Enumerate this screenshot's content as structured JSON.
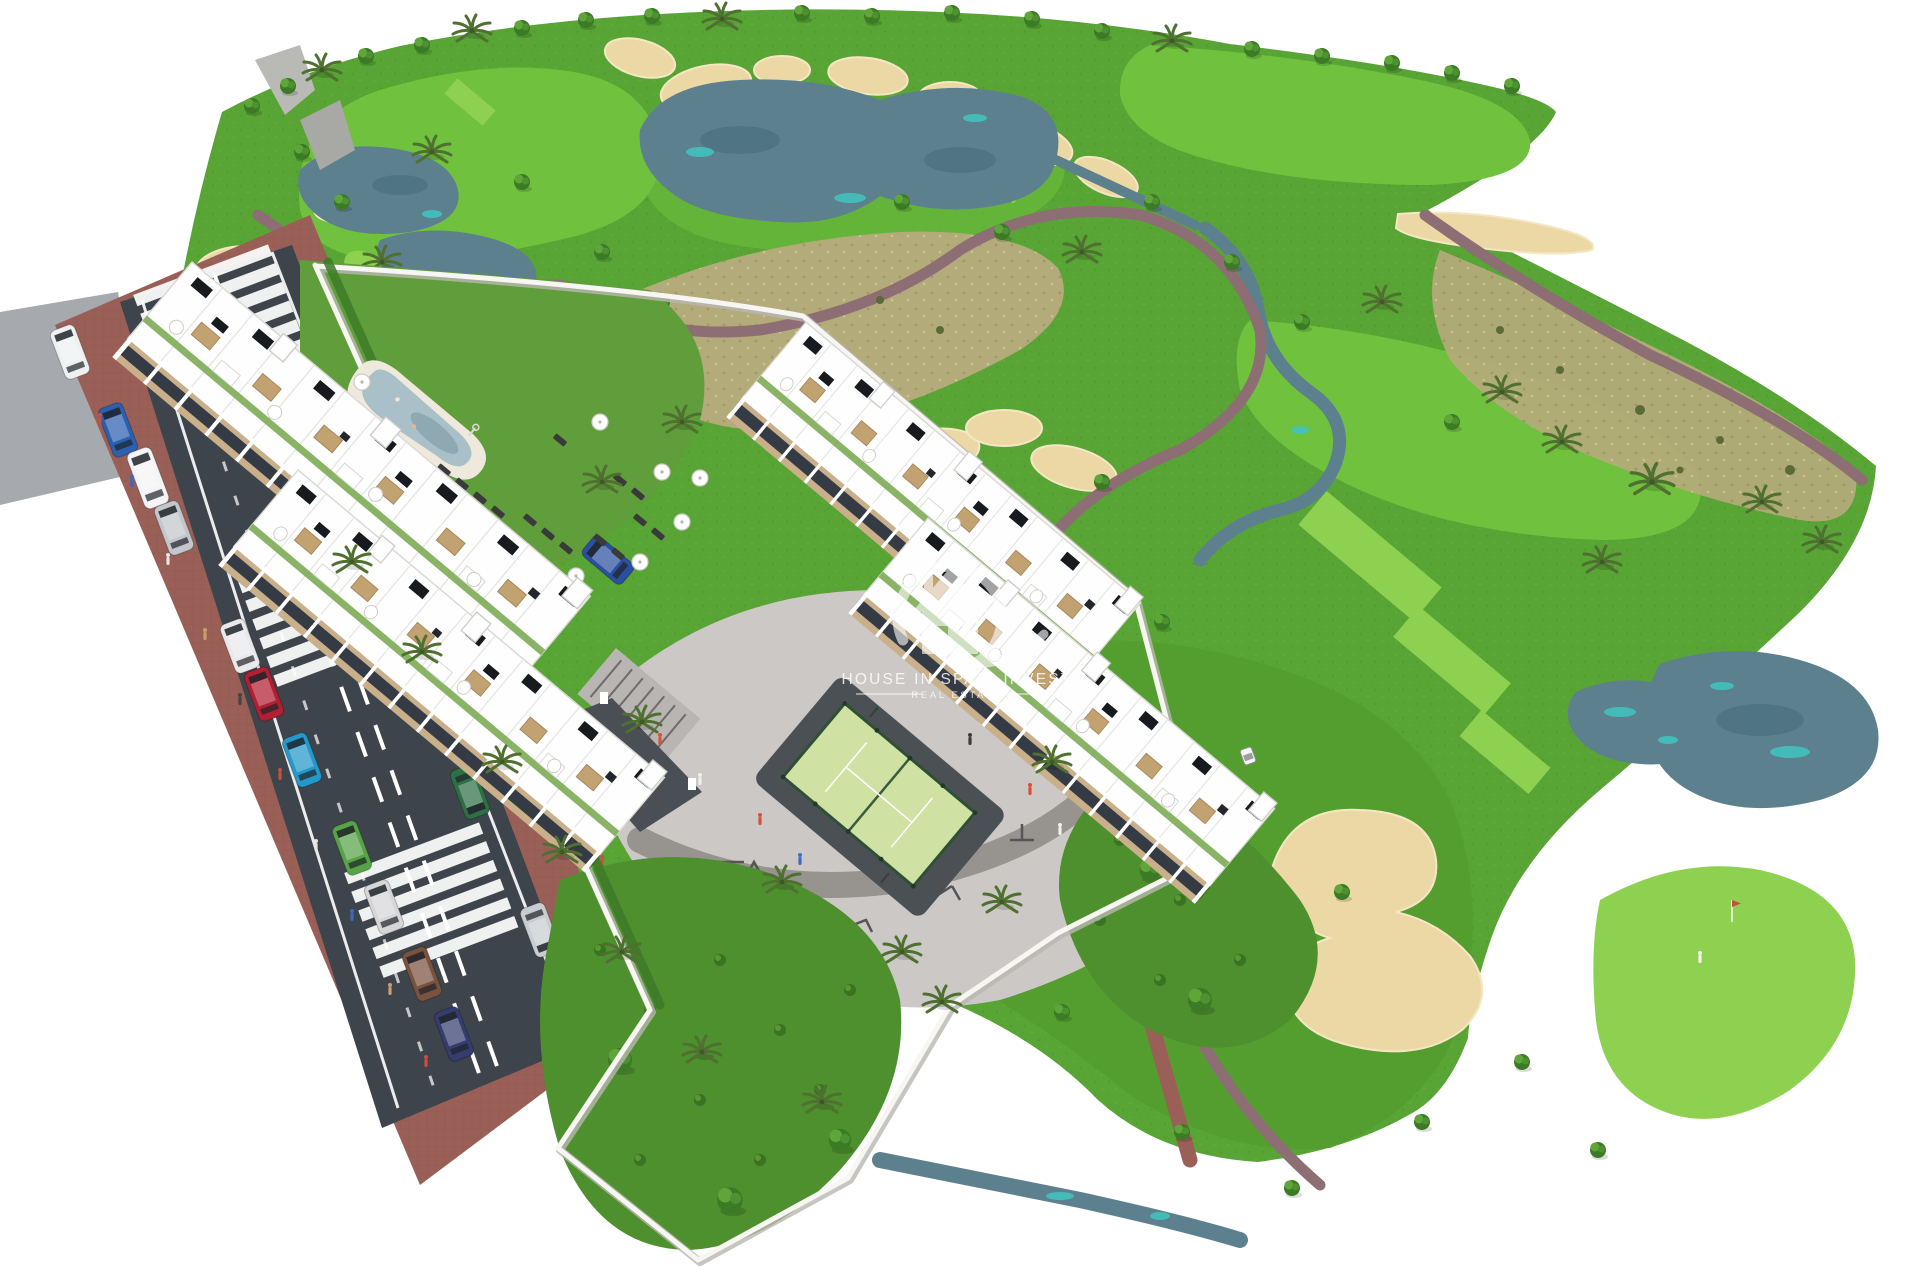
{
  "page": {
    "background": "#ffffff",
    "kind": "aerial-3d-architectural-render",
    "subject": "golf resort apartment development with access road, pool, playground and padel court"
  },
  "watermark": {
    "title": "HOUSE IN SPAIN INVEST",
    "subtitle": "REAL ESTATE",
    "logo": "house-swoosh-icon",
    "color": "#ffffff"
  },
  "palette": {
    "rough_green": "#58a434",
    "fairway_green": "#70c13e",
    "tee_green": "#8ed150",
    "field_green": "#549e30",
    "lawn_green": "#5f9e3b",
    "garden_green": "#4e8f2e",
    "dry_meadow": "#b3ab79",
    "sand_bunker": "#ecd8a4",
    "lake_water": "#5d808f",
    "lake_teal": "#3fc6c0",
    "golf_path": "#8d6e74",
    "sidewalk_brick": "#9a6057",
    "road_asphalt": "#3e444b",
    "plaza_paving": "#cbc8c6",
    "building_white": "#fefefe",
    "facade_wood": "#c9b08b",
    "window_glass": "#353b44",
    "solar_panel": "#171a1f",
    "pool_water": "#a9c0c8",
    "pool_deck": "#efe9dd",
    "padel_court": "#cfe2a4",
    "wall_white": "#f7f6f2"
  },
  "scene": {
    "features": [
      "golf-course",
      "lakes",
      "streams",
      "sand-bunkers",
      "cart-paths",
      "putting-greens",
      "tee-boxes",
      "golf-flag",
      "golfer",
      "golf-cart",
      "palm-trees",
      "deciduous-trees",
      "apartment-block-a1",
      "apartment-block-a2",
      "apartment-block-b1",
      "apartment-block-b2",
      "roof-terraces",
      "solar-panels",
      "pergolas",
      "swimming-pool",
      "pool-deck",
      "sun-loungers",
      "parasols",
      "playground-plaza",
      "outdoor-gym",
      "bike-racks",
      "padel-court",
      "access-road",
      "crosswalks",
      "parking-lane",
      "cars",
      "pedestrians",
      "perimeter-walls",
      "gardens",
      "driveway-entrance",
      "rocks"
    ]
  }
}
